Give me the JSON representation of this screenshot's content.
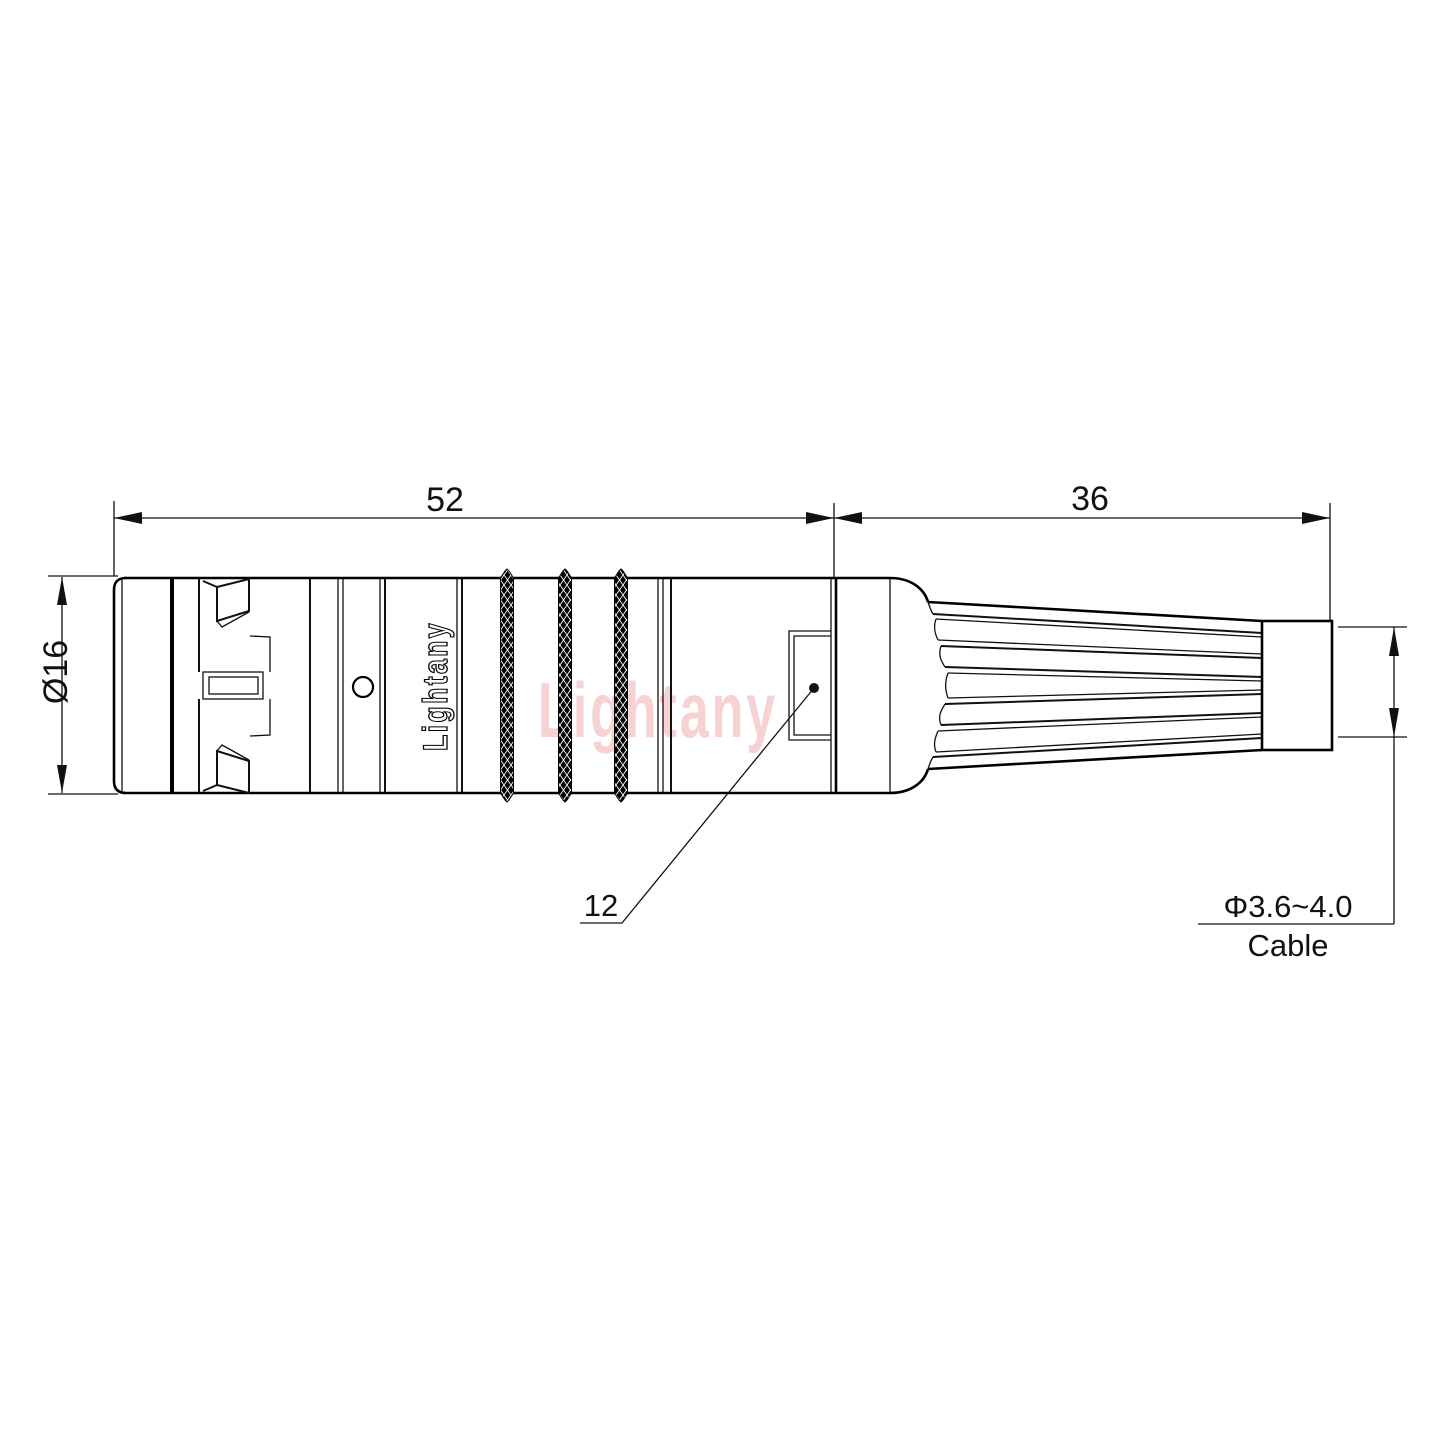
{
  "drawing": {
    "type": "connector-technical-drawing",
    "brand": "Lightany",
    "watermark": "Lightany",
    "dimensions": {
      "front_length": "52",
      "rear_length": "36",
      "outer_diameter": "Ø16",
      "mid_diameter": "12",
      "cable_diameter": "Φ3.6~4.0",
      "cable_label": "Cable"
    },
    "colors": {
      "line": "#000000",
      "background": "#ffffff",
      "watermark_pink": "#e25a5a"
    }
  }
}
